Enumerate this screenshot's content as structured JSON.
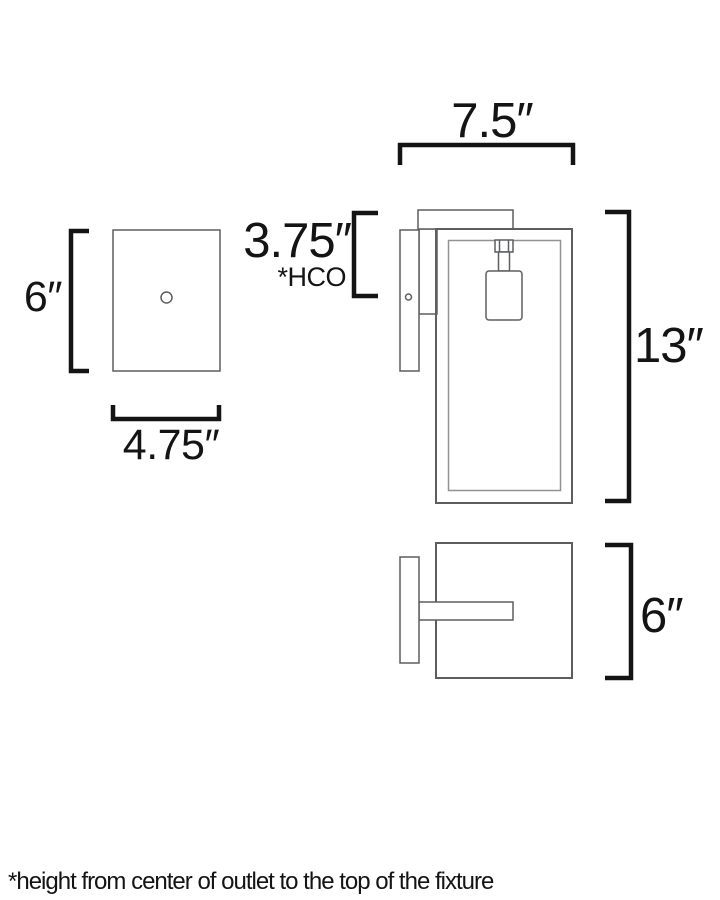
{
  "diagram": {
    "footnote": "*height from center of outlet to the top of the fixture",
    "colors": {
      "background": "#ffffff",
      "line": "#5d5e60",
      "line_light": "#909295",
      "bracket": "#141414",
      "text": "#141414"
    },
    "front_view": {
      "height_label": "6″",
      "width_label": "4.75″"
    },
    "side_view": {
      "width_label": "7.5″",
      "hco_label": "3.75″",
      "hco_note": "*HCO",
      "height_label": "13″"
    },
    "top_view": {
      "depth_label": "6″"
    }
  }
}
